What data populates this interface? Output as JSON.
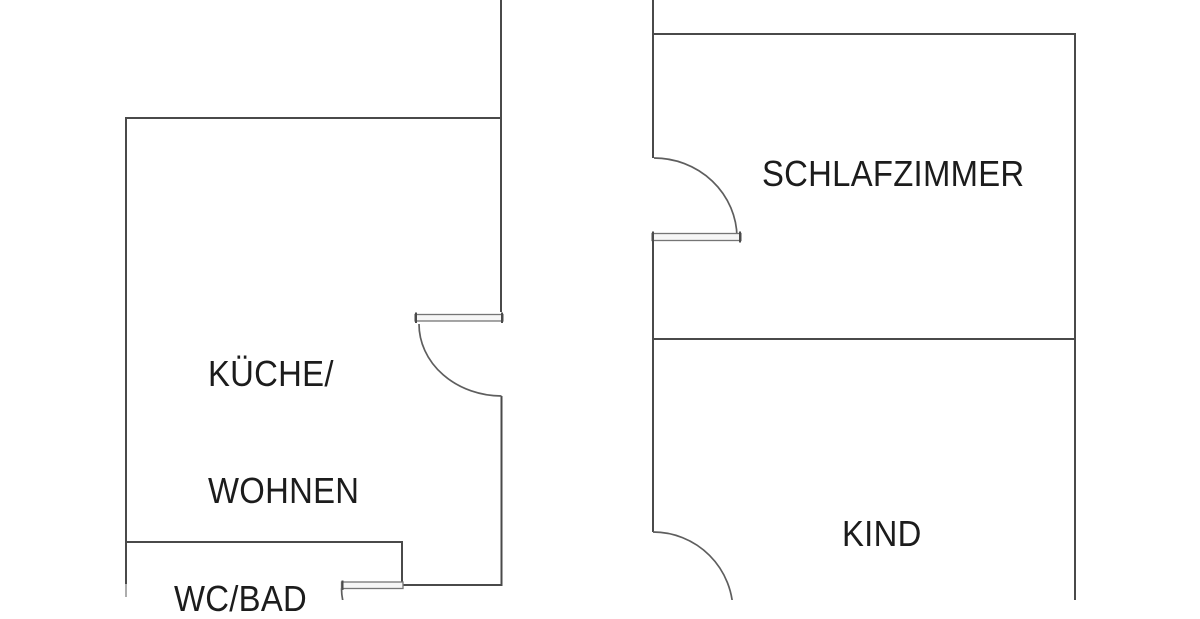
{
  "document_type": "floor-plan",
  "colors": {
    "wall": "#4a4a4a",
    "door": "#5e5e5e",
    "leaf-fill": "#f6f6f6",
    "leaf-stroke": "#757575",
    "text": "#1c1c1c",
    "background": "#ffffff"
  },
  "floorplan": {
    "rooms": [
      {
        "id": "kueche-wohnen",
        "label_line1": "KÜCHE/",
        "label_line2": "WOHNEN"
      },
      {
        "id": "schlafzimmer",
        "label": "SCHLAFZIMMER"
      },
      {
        "id": "kind",
        "label": "KIND"
      },
      {
        "id": "wc-bad",
        "label": "WC/BAD"
      }
    ],
    "doors": [
      {
        "id": "door-kueche",
        "type": "swing-door"
      },
      {
        "id": "door-wc-bad",
        "type": "swing-door"
      },
      {
        "id": "door-schlafzimmer",
        "type": "swing-door"
      },
      {
        "id": "door-kind",
        "type": "swing-door"
      }
    ]
  }
}
